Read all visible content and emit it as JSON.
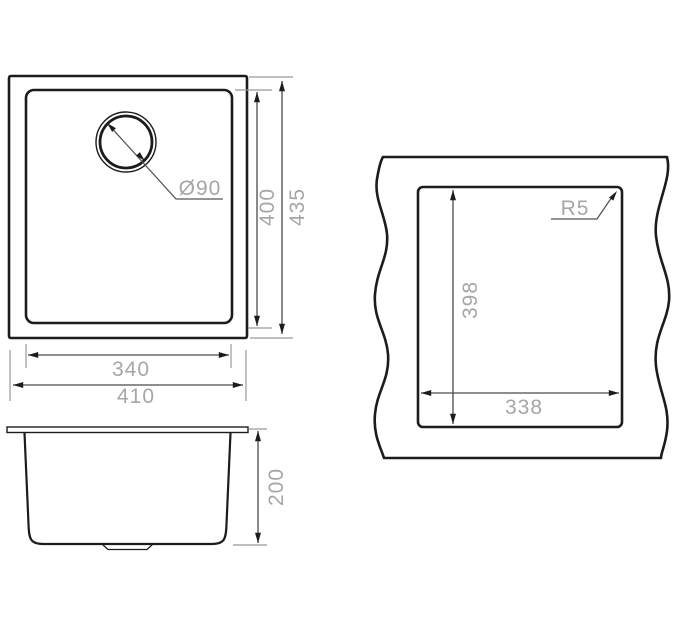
{
  "background": "#ffffff",
  "palette": {
    "object_line": "#1c1c1c",
    "dim_line": "#4a4a4a",
    "extension_line": "#999999",
    "label_color": "#a6a6a6"
  },
  "views": {
    "plan": {
      "labels": {
        "drain_diameter": "Ø90",
        "bowl_depth_dim": "400",
        "overall_depth_dim": "435",
        "bowl_width_dim": "340",
        "overall_width_dim": "410"
      }
    },
    "side": {
      "labels": {
        "height_dim": "200"
      }
    },
    "cutout": {
      "labels": {
        "height_dim": "398",
        "width_dim": "338",
        "corner_radius": "R5"
      }
    }
  }
}
